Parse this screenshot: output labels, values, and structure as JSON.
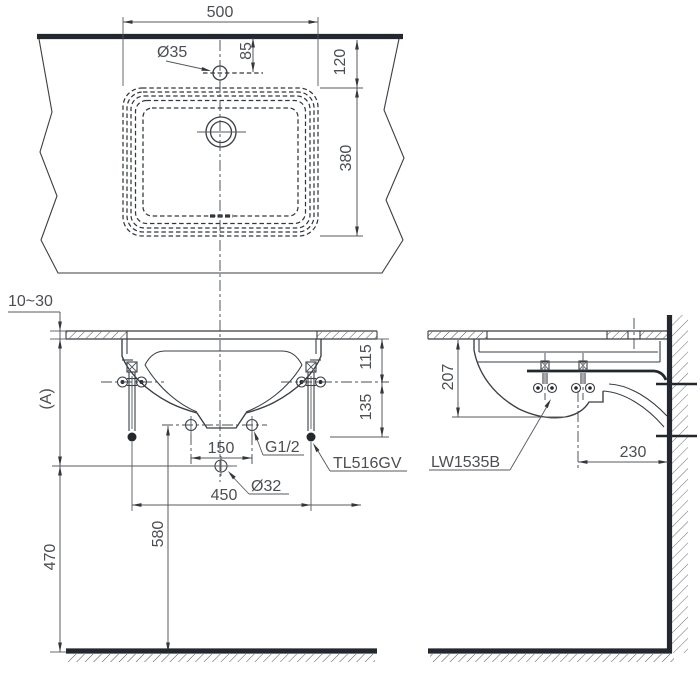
{
  "title": "Washbasin installation drawing",
  "views": {
    "top": {
      "dims": {
        "basin_width": "500",
        "faucet_hole_dia": "Ø35",
        "edge_to_faucet": "85",
        "edge_to_basin": "120",
        "basin_depth": "380"
      }
    },
    "front": {
      "dims": {
        "counter_thickness": "10~30",
        "counter_height_ref": "(A)",
        "drain_to_floor": "470",
        "supply_to_floor": "580",
        "supply_pitch": "150",
        "bolt_pitch": "450",
        "counter_to_supply": "115",
        "supply_to_bolt_end": "135"
      },
      "labels": {
        "supply_thread": "G1/2",
        "faucet_model": "TL516GV",
        "drain_hole_dia": "Ø32"
      }
    },
    "side": {
      "dims": {
        "counter_to_basin_bottom": "207",
        "drain_to_wall": "230"
      },
      "labels": {
        "basin_model": "LW1535B"
      }
    }
  },
  "colors": {
    "line": "#3a3f45",
    "heavy_line": "#23272e",
    "text": "#4b4e52",
    "background": "#ffffff"
  }
}
